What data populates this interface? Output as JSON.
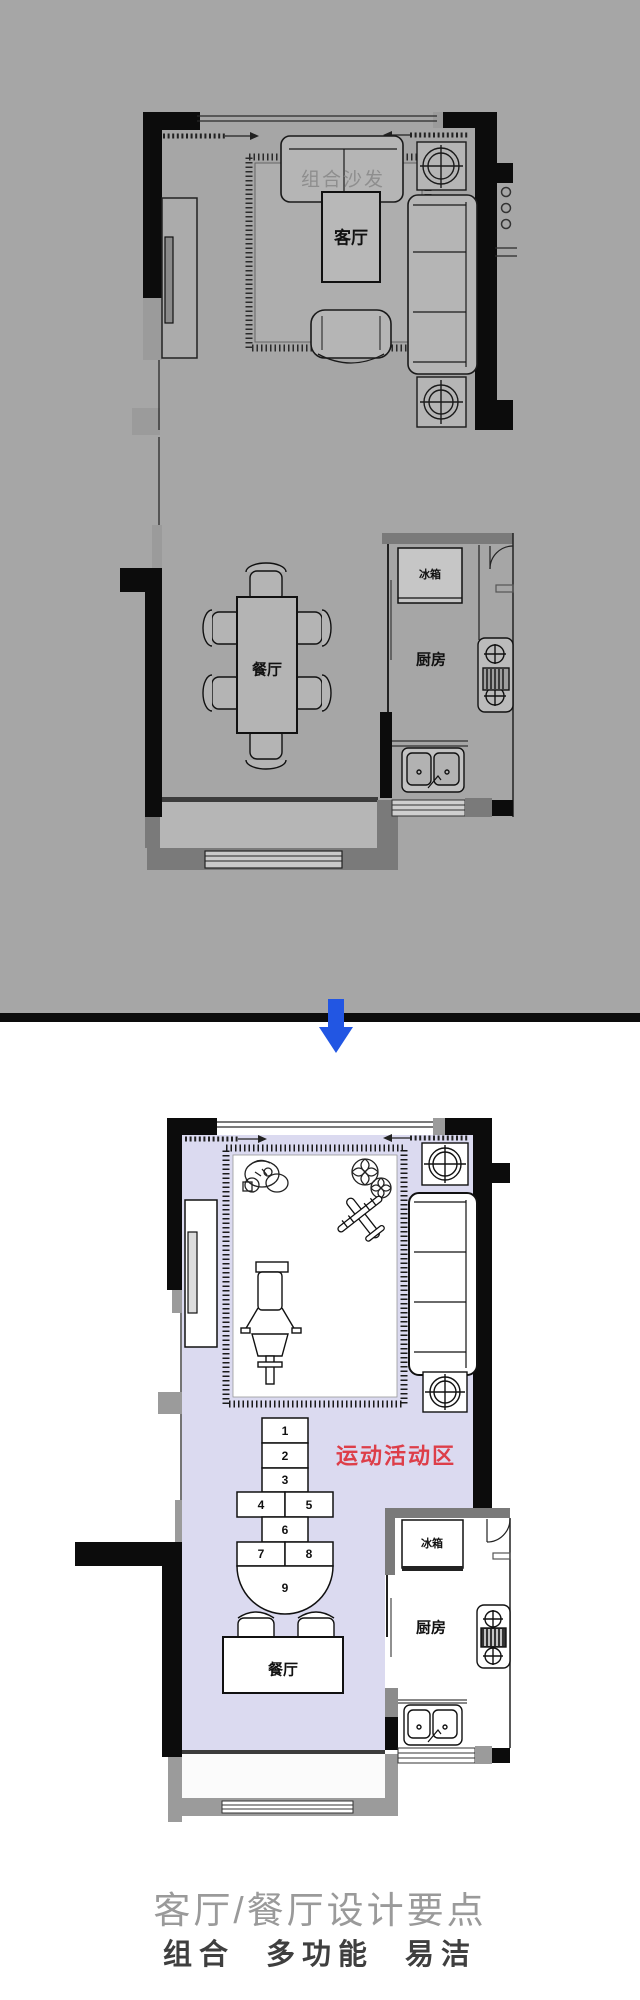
{
  "plan_before": {
    "sofa_label": "组合沙发",
    "living_room": "客厅",
    "dining_room": "餐厅",
    "kitchen": "厨房",
    "fridge": "冰箱"
  },
  "plan_after": {
    "activity_zone": "运动活动区",
    "dining_room": "餐厅",
    "kitchen": "厨房",
    "fridge": "冰箱",
    "hopscotch": [
      "1",
      "2",
      "3",
      "4",
      "5",
      "6",
      "7",
      "8",
      "9"
    ]
  },
  "footer": {
    "title": "客厅/餐厅设计要点",
    "subtitle": "组合 多功能 易洁"
  },
  "colors": {
    "background_gray": "#a6a6a6",
    "floor_lavender": "#dbdaf0",
    "accent_red": "#dd3e49",
    "arrow_blue": "#2256e3",
    "wall_black": "#0c0c0c",
    "wall_gray": "#7a7a7a"
  }
}
